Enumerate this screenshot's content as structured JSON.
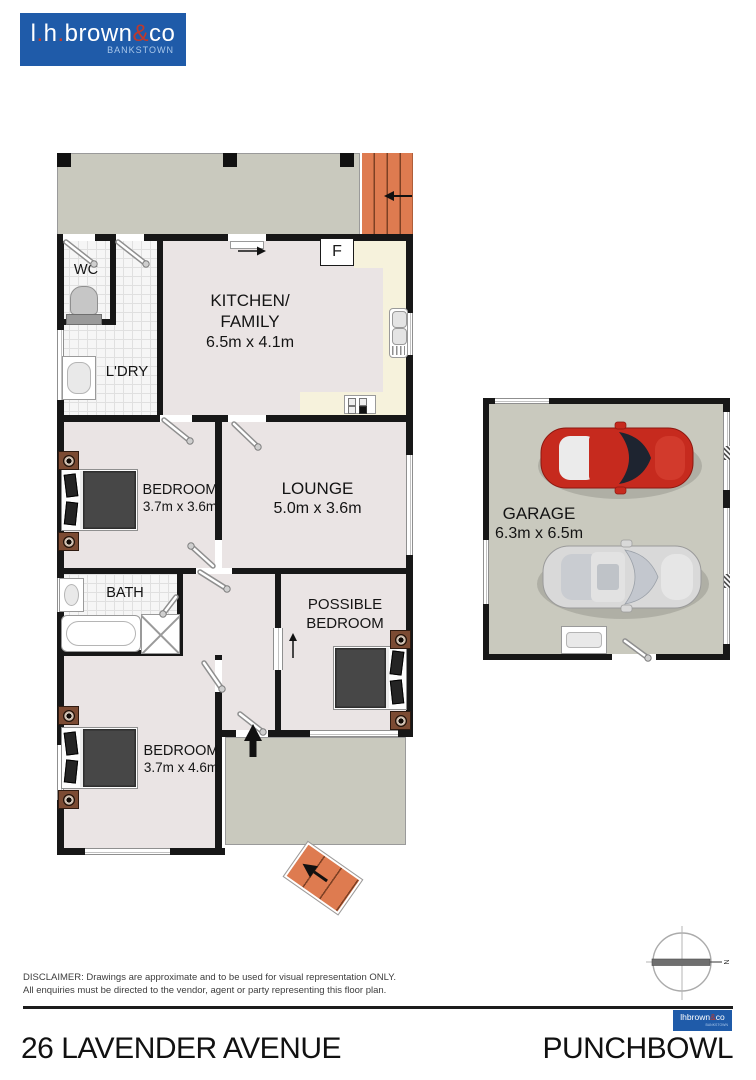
{
  "logo": {
    "part_l": "l",
    "dot": ".",
    "part_h": "h",
    "part_brown": "brown",
    "amp": "&",
    "part_co": "co",
    "tagline": "BANKSTOWN"
  },
  "plan": {
    "rooms": {
      "wc": {
        "label": "WC"
      },
      "laundry": {
        "label": "L'DRY"
      },
      "kitchen": {
        "line1": "KITCHEN/",
        "line2": "FAMILY",
        "dims": "6.5m x 4.1m"
      },
      "bedroom1": {
        "label": "BEDROOM",
        "dims": "3.7m x 3.6m"
      },
      "lounge": {
        "label": "LOUNGE",
        "dims": "5.0m x 3.6m"
      },
      "bath": {
        "label": "BATH"
      },
      "possible_bedroom": {
        "line1": "POSSIBLE",
        "line2": "BEDROOM"
      },
      "bedroom2": {
        "label": "BEDROOM",
        "dims": "3.7m x 4.6m"
      },
      "garage": {
        "label": "GARAGE",
        "dims": "6.3m x 6.5m"
      }
    },
    "fridge_label": "F",
    "compass_north_label": "N"
  },
  "footer": {
    "disclaimer_line1": "DISCLAIMER: Drawings are approximate and to be used for visual representation ONLY.",
    "disclaimer_line2": "All enquiries must be directed to the vendor, agent or party representing this floor plan.",
    "street": "26 LAVENDER AVENUE",
    "suburb": "PUNCHBOWL"
  },
  "colors": {
    "brand_blue": "#1F5BA9",
    "brand_red": "#C0392B",
    "brand_light_blue": "#A9C7EA",
    "stairs_orange": "#DE7B50",
    "wall_black": "#171717",
    "floor_pink": "#EAE4E4",
    "bench_cream": "#F6F2DC",
    "deck_gray": "#C9C9BE",
    "car_red": "#C62A1E",
    "car_silver": "#D8D8D8"
  }
}
